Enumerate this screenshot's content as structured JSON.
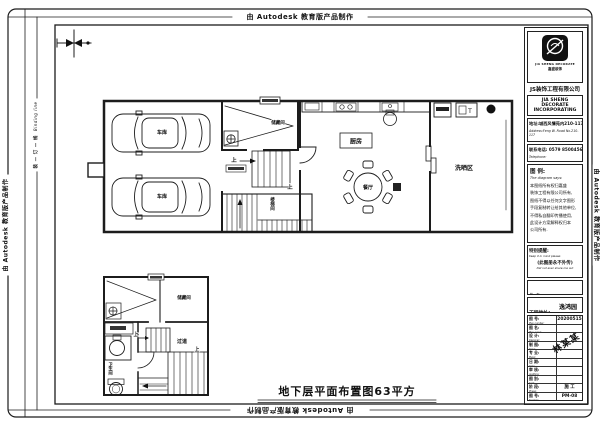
{
  "sheet": {
    "autodesk_stamp": "由 Autodesk 教育版产品制作",
    "binding_line": "装 — 订 — 线",
    "binding_line_en": "Binding line",
    "caption": "地下层平面布置图63平方"
  },
  "plan": {
    "garage": "车库",
    "storage": "储藏间",
    "kitchen": "厨房",
    "dining": "餐厅",
    "laundry": "洗晒区",
    "stairwell": "楼梯间",
    "up": "上",
    "heater_t": "T"
  },
  "small_plan": {
    "storage": "储藏间",
    "hall": "过道",
    "bath": "卫生间",
    "up": "上"
  },
  "titleblock": {
    "logo_caption": "JIA SHENG DECORATE",
    "logo_sub1": "嘉盛装饰",
    "logo_sub2": "JIASHENG DECORATION",
    "company_cn": "JS装饰工程有限公司",
    "company_en1": "JIA SHENG DECORATE",
    "company_en2": "INCORPORATING",
    "address_cn": "地址:城西风情苑内210-117号",
    "address_en": "Address:Feng W. Road No.210-117",
    "phone_cn": "联系电话: 0579 8500456",
    "phone_en": "Telephone:",
    "legend_title": "图 例:",
    "legend_en": "The diagram says:",
    "legend_lines": [
      "本图纸所有权归嘉盛",
      "装饰工程有限公司所有,",
      "图纸不得以任何文字图形",
      "手段复制转让给其他单位,",
      "不得私自翻印传播使用,",
      "此设计方案解释权归本",
      "公司所有."
    ],
    "notice_title": "特别提醒:",
    "notice_en": "Keep it in mind please:",
    "notice_body": "(此图册永不外传)",
    "notice_body_en": "Did not ever share me out",
    "owner_label": "业 主:",
    "owner_en": "Owner:",
    "site_label": "工程地址:",
    "site_en": "Construction address:",
    "site_value": "逸鸿园",
    "stamp": "林某某",
    "rows": [
      {
        "label": "图 号:",
        "en": "Plan number:",
        "value": "20200515"
      },
      {
        "label": "图 名:",
        "en": "Plan name:",
        "value": ""
      },
      {
        "label": "设 计:",
        "en": "Designer:",
        "value": ""
      },
      {
        "label": "制 图:",
        "en": "Draw:",
        "value": ""
      },
      {
        "label": "专 业:",
        "en": "Major:",
        "value": ""
      },
      {
        "label": "日 期:",
        "en": "Date:",
        "value": ""
      },
      {
        "label": "审 核:",
        "en": "Auditing:",
        "value": ""
      },
      {
        "label": "图 别:",
        "en": "Sort:",
        "value": ""
      },
      {
        "label": "阶 段:",
        "en": "Phase:",
        "value": "施 工"
      },
      {
        "label": "图 号:",
        "en": "Number:",
        "value": "PM-08"
      }
    ]
  }
}
